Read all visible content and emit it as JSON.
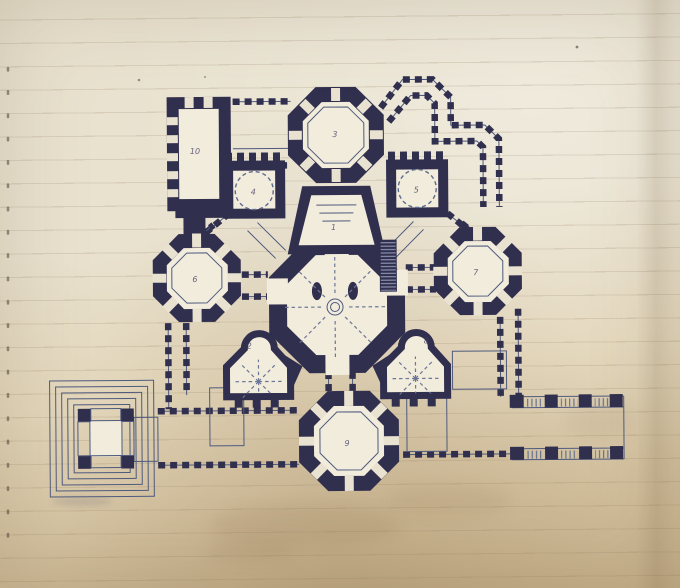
{
  "scene": {
    "description": "Hand-drawn architectural floor plan of a domed, multi-towered building, ink on aged ruled notebook paper",
    "colors": {
      "ink": "#312f4e",
      "ink_light": "#5d6b8e",
      "paper": "#e9e2cf",
      "paper_shadow": "#c7b18c",
      "rule_line": "#927c5e",
      "room_floor": "#f2ecdc"
    }
  },
  "rooms": [
    {
      "id": "apse",
      "label": "1"
    },
    {
      "id": "left-chapel",
      "label": "2"
    },
    {
      "id": "north-octagon-tower",
      "label": "3"
    },
    {
      "id": "northwest-rotunda",
      "label": "4"
    },
    {
      "id": "northeast-rotunda",
      "label": "5"
    },
    {
      "id": "west-octagon-tower",
      "label": "6"
    },
    {
      "id": "east-octagon-tower",
      "label": "7"
    },
    {
      "id": "right-chapel",
      "label": "8"
    },
    {
      "id": "south-octagon-tower",
      "label": "9"
    },
    {
      "id": "northwest-hall",
      "label": "10"
    }
  ]
}
